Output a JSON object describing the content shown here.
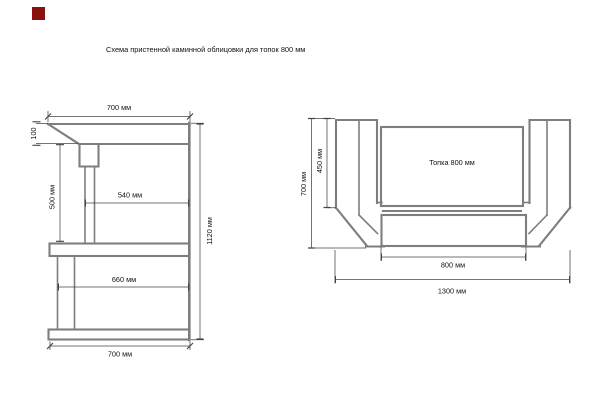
{
  "title": "Схема пристенной каминной облицовки для топок 800 мм",
  "marker_color": "#8b1111",
  "colors": {
    "structure": "#7e7e7e",
    "dimension": "#454545",
    "text": "#111111",
    "background": "#ffffff"
  },
  "left_view": {
    "dim_top_width": "700 мм",
    "dim_top_thickness": "100",
    "dim_opening_height": "500 мм",
    "dim_opening_depth": "540 мм",
    "dim_total_height": "1120 мм",
    "dim_base_depth": "660 мм",
    "dim_bottom_width": "700 мм"
  },
  "right_view": {
    "dim_total_height": "700 мм",
    "dim_firebox_height": "450 мм",
    "firebox_label": "Топка 800 мм",
    "dim_firebox_width": "800 мм",
    "dim_total_width": "1300 мм"
  }
}
